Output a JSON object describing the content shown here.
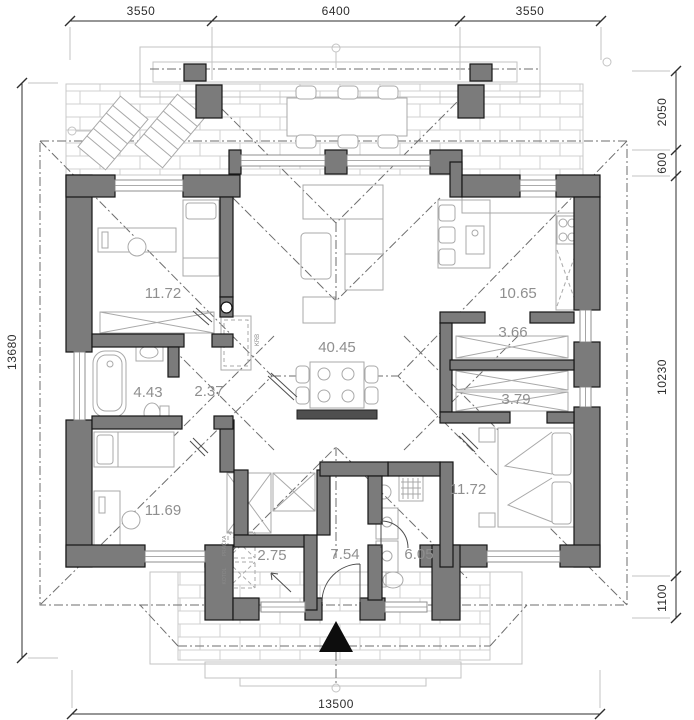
{
  "title": "Ground floor plan",
  "dims": {
    "top": [
      "3550",
      "6400",
      "3550"
    ],
    "right": [
      "2050",
      "600",
      "10230",
      "1100"
    ],
    "left": [
      "13680"
    ],
    "bottom": [
      "13500"
    ]
  },
  "rooms": [
    {
      "name": "bedroom-1",
      "area": "11.72"
    },
    {
      "name": "kitchen",
      "area": "10.65"
    },
    {
      "name": "closet-1",
      "area": "3.66"
    },
    {
      "name": "living-room",
      "area": "40.45"
    },
    {
      "name": "bathroom-1",
      "area": "4.43"
    },
    {
      "name": "hallway",
      "area": "2.37"
    },
    {
      "name": "closet-2",
      "area": "3.79"
    },
    {
      "name": "bedroom-2",
      "area": "11.72"
    },
    {
      "name": "bedroom-3",
      "area": "11.69"
    },
    {
      "name": "utility-room",
      "area": "2.75"
    },
    {
      "name": "entry-hall",
      "area": "7.54"
    },
    {
      "name": "bathroom-2",
      "area": "6.05"
    }
  ],
  "annotations": {
    "fireplace": "KRB",
    "washer": "PRÁČKA",
    "boiler": "KOTOL"
  },
  "colors": {
    "wall": "#7b7b7b",
    "furniture": "#a9a9a9",
    "brick": "#d0d0d0",
    "dash": "#6e6e6e",
    "dim": "#2e2e2e",
    "room_label": "#8f8f8f"
  }
}
